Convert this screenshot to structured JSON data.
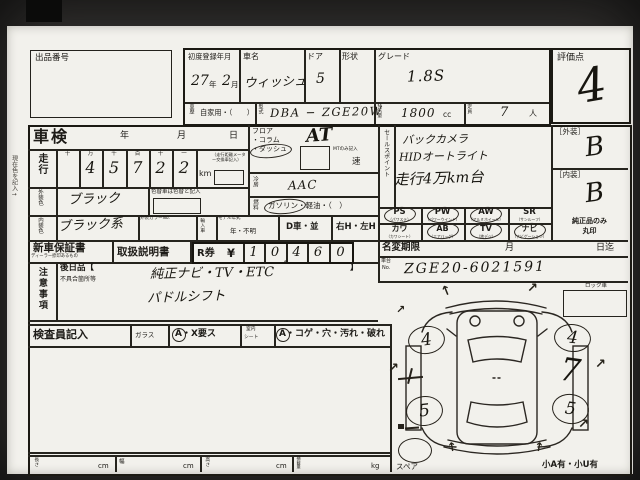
{
  "side_note": "現在色を記入→",
  "header": {
    "lot_no_label": "出品番号",
    "first_reg_label": "初度登録年月",
    "first_reg_year": "27",
    "first_reg_year_label": "年",
    "first_reg_month": "2",
    "first_reg_month_label": "月",
    "car_name_label": "車名",
    "car_name_value": "ウィッシュ",
    "door_label": "ドア",
    "door_value": "5",
    "shape_label": "形状",
    "grade_label": "グレード",
    "grade_value": "1.8S",
    "history_label": "車歴",
    "history_value": "自家用・（　　）",
    "model_code_label": "型式",
    "model_code_value": "DBA − ZGE20W",
    "displacement_label": "排気量",
    "displacement_value": "1800",
    "displacement_unit": "cc",
    "capacity_label": "定員",
    "capacity_value": "7",
    "capacity_unit": "人",
    "score_label": "評価点",
    "score_value": "4"
  },
  "shaken": {
    "title": "車検",
    "year_label": "年",
    "month_label": "月",
    "day_label": "日"
  },
  "mileage": {
    "label": "走行",
    "digit_headers": [
      "十",
      "万",
      "千",
      "百",
      "十",
      "一"
    ],
    "digits": [
      "",
      "4",
      "5",
      "7",
      "2",
      "2"
    ],
    "unit": "km",
    "unit_note": "（走行距離メーター交換車記入）"
  },
  "exterior_color": {
    "label": "外装色",
    "value": "ブラック",
    "change_note": "色替車は色替と記入"
  },
  "interior_color": {
    "label": "内装色",
    "value": "ブラック系",
    "color_no_label": "外装カラーNo.",
    "import_label": "輸入車",
    "model_year_label": "モデル年式",
    "model_year_value": "年・不明"
  },
  "transmission": {
    "position_lines": [
      "フロア",
      "・コラム",
      "・ダッシュ"
    ],
    "dash_circled": true,
    "value": "AT",
    "mt_note": "MTのみ記入",
    "speed_suffix": "速"
  },
  "aircon": {
    "label": "冷房",
    "value": "AAC"
  },
  "fuel": {
    "label": "燃料",
    "options": "ガソリン・軽油・（　）",
    "gasoline_circled": true
  },
  "drive_row": {
    "domestic": "D車・並",
    "handle": "右H・左H"
  },
  "sales_points": {
    "label": "セールスポイント",
    "lines": [
      "バックカメラ",
      "HIDオートライト",
      "走行4万km台"
    ]
  },
  "equipment": {
    "items": [
      {
        "code": "PS",
        "sub": "（パワステ）",
        "circled": true
      },
      {
        "code": "PW",
        "sub": "（パワーウインド）",
        "circled": true
      },
      {
        "code": "AW",
        "sub": "（アルミホイール）",
        "circled": true
      },
      {
        "code": "SR",
        "sub": "（サンルーフ）",
        "circled": false
      },
      {
        "code": "カワ",
        "sub": "（カワシート）",
        "circled": false
      },
      {
        "code": "AB",
        "sub": "（エアバッグ）",
        "circled": true
      },
      {
        "code": "TV",
        "sub": "（地デジ）",
        "circled": true
      },
      {
        "code": "ナビ",
        "sub": "（ナビゲーション）",
        "circled": true
      }
    ]
  },
  "name_change": {
    "label": "名変期限",
    "month_label": "月",
    "until_label": "日迄"
  },
  "chassis": {
    "label_top": "車台",
    "label_bottom": "No.",
    "value": "ZGE20-6021591"
  },
  "lock_car": {
    "label": "ロック車"
  },
  "grades": {
    "exterior_label": "［外装］",
    "exterior_value": "B",
    "interior_label": "［内装］",
    "interior_value": "B",
    "genuine_line1": "純正品のみ",
    "genuine_line2": "丸印"
  },
  "warranty": {
    "title": "新車保証書",
    "subtitle": "ディーラー捺印あるもの",
    "manual": "取扱説明書"
  },
  "ticket": {
    "label": "R券",
    "currency": "¥",
    "digits": [
      "1",
      "0",
      "4",
      "6",
      "0"
    ],
    "comma": ","
  },
  "notes": {
    "label": "注意事項",
    "later_open": "後日品【",
    "later_close": "】",
    "defect_label": "不具合箇所等",
    "lines": [
      "純正ナビ・TV・ETC",
      "パドルシフト"
    ]
  },
  "inspector": {
    "label": "検査員記入",
    "glass_label": "ガラス",
    "glass_value": "A・X要ス",
    "glass_circled": true,
    "seat_label_top": "室内",
    "seat_label_bottom": "シート",
    "seat_value": "A・コゲ・穴・汚れ・破れ",
    "seat_circled": true
  },
  "dimensions": {
    "length_label": "長さ",
    "width_label": "幅",
    "height_label": "高さ",
    "load_label": "積載量",
    "cm_unit": "cm",
    "kg_unit": "kg"
  },
  "diagram": {
    "spare_label": "スペア",
    "damage_note": "小A有・小U有",
    "wheel_fl": "4",
    "wheel_fr": "4",
    "wheel_rl": "5",
    "wheel_rr": "5",
    "side_mark": "7",
    "arrow_up": "↑",
    "arrow_ne": "↗"
  }
}
